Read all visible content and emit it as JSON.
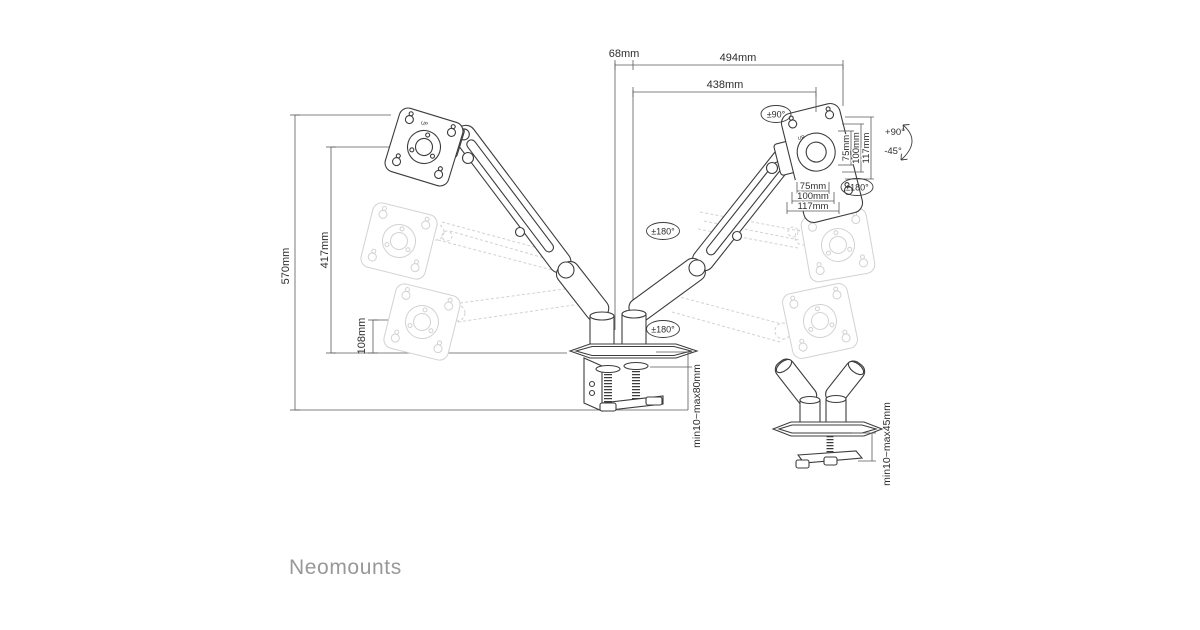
{
  "page": {
    "background": "#ffffff"
  },
  "brand": {
    "name": "Neomounts",
    "color": "#98989a"
  },
  "drawing": {
    "colors": {
      "line": "#3c3c3c",
      "dim_line": "#5a5a5a",
      "text": "#2e2e2e",
      "ghost": "#d2d2d2"
    },
    "dims": {
      "top_offset": "68mm",
      "reach_full": "494mm",
      "reach_arm": "438mm",
      "height_total": "570mm",
      "height_arm": "417mm",
      "height_min": "108mm",
      "vesa_v_75": "75mm",
      "vesa_v_100": "100mm",
      "vesa_v_117": "117mm",
      "vesa_h_75": "75mm",
      "vesa_h_100": "100mm",
      "vesa_h_117": "117mm",
      "clamp_range": "min10~max80mm",
      "grommet_range": "min10~max45mm"
    },
    "angles": {
      "swivel_top": "±90°",
      "rotate_elbow": "±180°",
      "rotate_base": "±180°",
      "rotate_vesa": "±180°",
      "tilt_up": "+90°",
      "tilt_down": "-45°"
    },
    "plate_marking": "UP"
  }
}
